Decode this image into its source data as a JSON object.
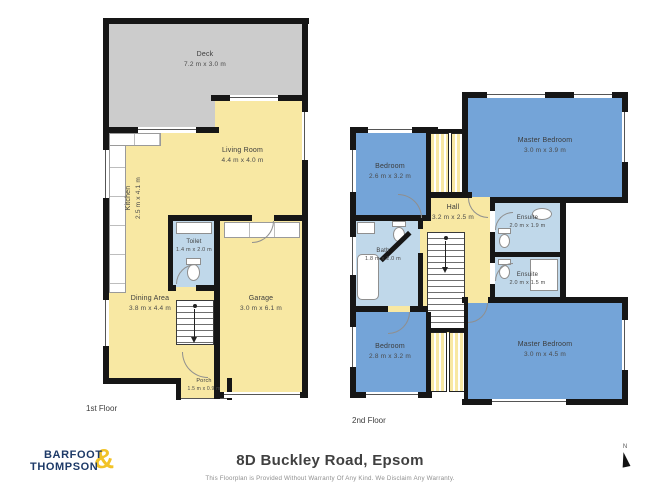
{
  "floor1": {
    "label": "1st Floor",
    "rooms": {
      "deck": {
        "name": "Deck",
        "dims": "7.2 m x 3.0 m"
      },
      "living": {
        "name": "Living Room",
        "dims": "4.4 m x 4.0 m"
      },
      "kitchen": {
        "name": "Kitchen",
        "dims": "2.5 m x 4.1 m"
      },
      "toilet": {
        "name": "Toilet",
        "dims": "1.4 m x 2.0 m"
      },
      "dining": {
        "name": "Dining Area",
        "dims": "3.8 m x 4.4 m"
      },
      "garage": {
        "name": "Garage",
        "dims": "3.0 m x 6.1 m"
      },
      "porch": {
        "name": "Porch",
        "dims": "1.5 m x 0.9 m"
      }
    }
  },
  "floor2": {
    "label": "2nd Floor",
    "rooms": {
      "bedroom_top": {
        "name": "Bedroom",
        "dims": "2.6 m x 3.2 m"
      },
      "master_top": {
        "name": "Master Bedroom",
        "dims": "3.0 m x 3.9 m"
      },
      "hall": {
        "name": "Hall",
        "dims": "3.2 m x 2.5 m"
      },
      "bath": {
        "name": "Bath",
        "dims": "1.8 m x 2.0 m"
      },
      "ensuite_top": {
        "name": "Ensuite",
        "dims": "2.0 m x 1.9 m"
      },
      "ensuite_bottom": {
        "name": "Ensuite",
        "dims": "2.0 m x 1.5 m"
      },
      "bedroom_bottom": {
        "name": "Bedroom",
        "dims": "2.8 m x 3.2 m"
      },
      "master_bottom": {
        "name": "Master Bedroom",
        "dims": "3.0 m x 4.5 m"
      }
    }
  },
  "footer": {
    "logo": {
      "word1": "BARFOOT",
      "word2": "THOMPSON",
      "ampersand": "&"
    },
    "title": "8D Buckley Road, Epsom",
    "disclaimer": "This Floorplan is Provided Without Warranty Of Any Kind. We Disclaim Any Warranty.",
    "compass_label": "N"
  },
  "colors": {
    "wall": "#161616",
    "deck_gray": "#cccccc",
    "floor_yellow": "#f8e8a3",
    "bedroom_blue": "#74a4d8",
    "bath_blue": "#c0d8ea",
    "logo_navy": "#1d3a68",
    "logo_gold": "#f2c327"
  }
}
